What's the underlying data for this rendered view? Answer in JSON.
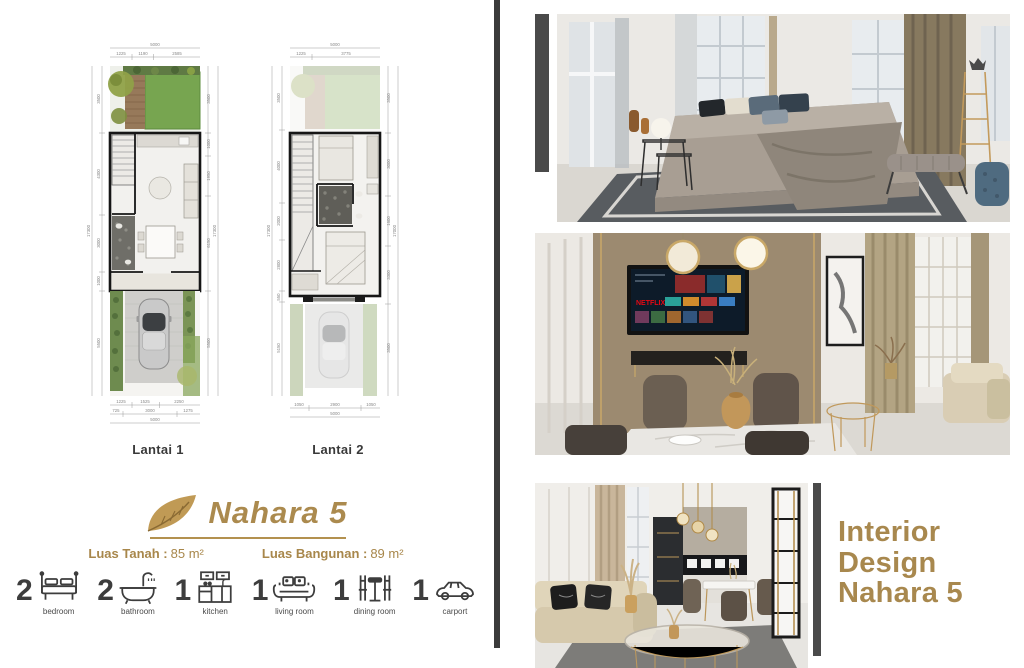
{
  "brand": {
    "name": "Nahara 5",
    "leaf_icon": "gold-leaf-icon"
  },
  "areas": {
    "land_label": "Luas Tanah :",
    "land_value": "85 m²",
    "building_label": "Luas Bangunan :",
    "building_value": "89 m²"
  },
  "features": {
    "items": [
      {
        "count": "2",
        "label": "bedroom",
        "icon": "bed-icon"
      },
      {
        "count": "2",
        "label": "bathroom",
        "icon": "bathtub-icon"
      },
      {
        "count": "1",
        "label": "kitchen",
        "icon": "kitchen-cabinet-icon"
      },
      {
        "count": "1",
        "label": "living room",
        "icon": "sofa-icon"
      },
      {
        "count": "1",
        "label": "dining room",
        "icon": "dining-table-icon"
      },
      {
        "count": "1",
        "label": "carport",
        "icon": "car-icon"
      }
    ]
  },
  "plans": {
    "lantai1": {
      "label": "Lantai 1",
      "dims": {
        "top_total": "5000",
        "top": [
          "1225",
          "1190",
          "2585"
        ],
        "left": [
          "3500",
          "4300",
          "3000",
          "1000",
          "5500"
        ],
        "left_total": "17300",
        "right": [
          "3500",
          "1000",
          "1950",
          "6150",
          "5500"
        ],
        "right_total": "17300",
        "bottom_row1": [
          "1225",
          "1525",
          "2250"
        ],
        "bottom_row2": [
          "725",
          "3000",
          "1275"
        ],
        "bottom_total": "5000"
      }
    },
    "lantai2": {
      "label": "Lantai 2",
      "dims": {
        "top_total": "5000",
        "top": [
          "1225",
          "3775"
        ],
        "left": [
          "3500",
          "4000",
          "2000",
          "2800",
          "550",
          "5150"
        ],
        "left_total": "17300",
        "right": [
          "3500",
          "3000",
          "1600",
          "3300",
          "3500"
        ],
        "right_total": "17000",
        "bottom": [
          "1050",
          "2900",
          "1050"
        ],
        "bottom_total": "5000"
      }
    }
  },
  "photos": {
    "bedroom": {
      "name": "bedroom-render"
    },
    "dining": {
      "name": "dining-room-render",
      "tv_badge": "NETFLIX"
    },
    "living": {
      "name": "living-room-render"
    }
  },
  "right_title": {
    "lines": [
      "Interior",
      "Design",
      "Nahara 5"
    ]
  },
  "colors": {
    "accent_gold": "#ab8a4e",
    "divider_dark": "#3b3b3b"
  }
}
